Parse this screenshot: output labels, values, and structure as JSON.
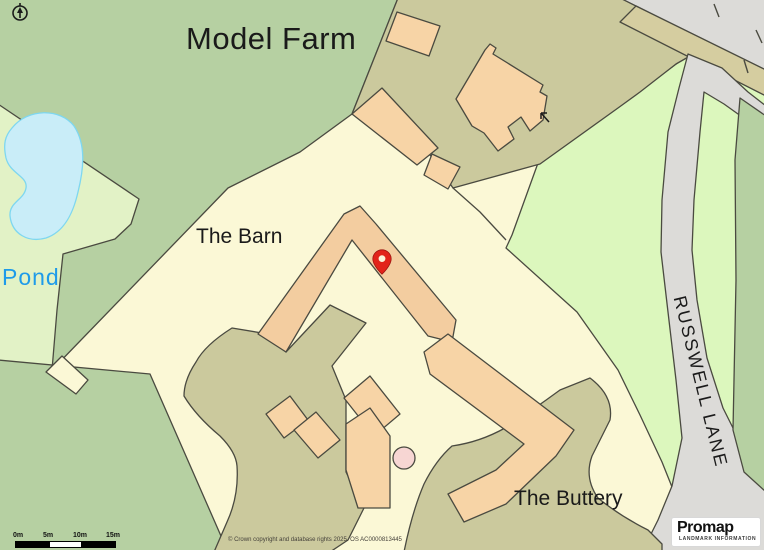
{
  "map": {
    "labels": {
      "model_farm": "Model Farm",
      "the_barn": "The Barn",
      "pond": "Pond",
      "the_buttery": "The Buttery",
      "russwell_lane": "RUSSWELL LANE"
    },
    "marker": {
      "name": "location-pin",
      "color": "#E2231A"
    },
    "scale_bar": {
      "ticks": [
        "0m",
        "5m",
        "10m",
        "15m"
      ]
    },
    "copyright": "© Crown copyright and database rights 2025. OS AC0000813445",
    "logo": {
      "name": "Promap",
      "tagline": "LANDMARK INFORMATION",
      "bullet_color": "#F59A23"
    },
    "colors": {
      "field_green": "#B6D0A2",
      "pond_field_green": "#E2F2C6",
      "verge_green": "#DCF7BD",
      "cream": "#FBF8D6",
      "farmyard_khaki": "#CBC99D",
      "road_gray": "#DCDBD8",
      "road_tan": "#D5CDA0",
      "building_orange": "#F7D4A6",
      "barn_orange": "#F3CDA0",
      "pond_blue": "#C9EDF8",
      "tank_pink": "#F7D6D3",
      "pin_red": "#E2231A",
      "pond_label_blue": "#1E9BE9"
    }
  }
}
